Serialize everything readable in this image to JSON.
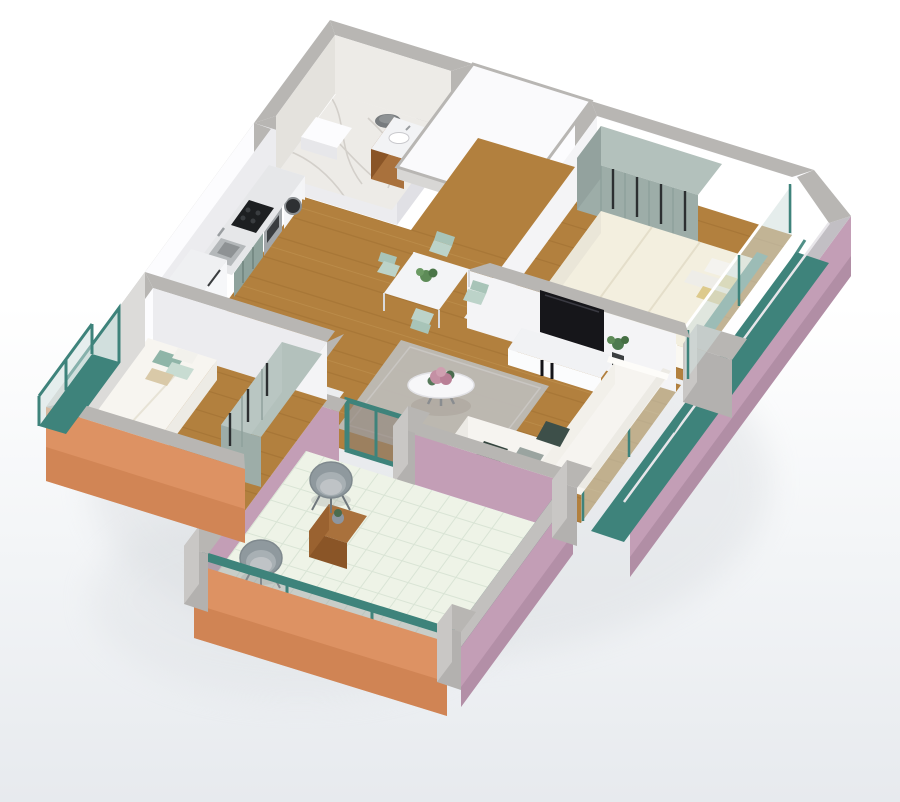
{
  "scene": {
    "title": "3D isometric apartment floor plan render",
    "type": "architectural-visualization",
    "no_visible_text": true
  },
  "palette": {
    "bg_top": "#ffffff",
    "bg_bottom": "#e7eaee",
    "cut": "#b8b6b3",
    "cut_light": "#c9c7c4",
    "wall_white": "#fcfcfe",
    "wall_light": "#f4f4f6",
    "wall_shade": "#ececef",
    "wall_shade2": "#e0e0e5",
    "marble": "#edebe7",
    "marble_vein": "#d0cdc7",
    "wood": "#b2803e",
    "wood_line": "#8f6128",
    "wood_hi": "#caa05f",
    "furniture_wood": "#a9713c",
    "furniture_wood_dark": "#8a5527",
    "pink": "#c39eb6",
    "pink_dark": "#a8859c",
    "orange": "#dd9263",
    "orange_dark": "#c57848",
    "teal": "#3e837b",
    "teal_dark": "#2f6e66",
    "glass": "#cfdfdd",
    "glass_gray": "#9aa0a2",
    "sage": "#b3c1bc",
    "sage_dark": "#9dada8",
    "cream": "#f3efdf",
    "rug": "#bdbab6",
    "rug_line": "#c9c6c2",
    "tile": "#eef3e7",
    "tile_line": "#d9e4d5",
    "sofa": "#f6f4f0",
    "tv_black": "#16161a",
    "steel": "#a3a7aa",
    "mint": "#bcd3c9",
    "mint_dark": "#a8c4b8",
    "chair_gray": "#8f999e",
    "shadow": "#d7dade"
  },
  "rooms": {
    "bathroom": {
      "label": "Bathroom with marble walls, vanity sink and toilet"
    },
    "entry_hall": {
      "label": "Entry hall with white ceiling slab"
    },
    "bedroom_primary": {
      "label": "Primary bedroom with double bed and sage wardrobe"
    },
    "living_room": {
      "label": "Living room with sectional sofa, rug, coffee table and TV"
    },
    "kitchen": {
      "label": "Kitchen with counter, cooktop, oven, sink, washer and fridge"
    },
    "dining": {
      "label": "Dining table with mint chairs"
    },
    "bedroom_second": {
      "label": "Second bedroom with bed, wardrobe and juliet balcony"
    },
    "terrace": {
      "label": "Tiled terrace with round chairs and wooden cube table"
    },
    "balcony_east": {
      "label": "East balcony with teal floor and pink parapet"
    }
  },
  "furniture": {
    "bathroom": [
      "vanity-sink",
      "toilet",
      "shower-tray",
      "glass-panel"
    ],
    "kitchen": [
      "counter",
      "cooktop",
      "oven",
      "sink",
      "washing-machine",
      "fridge"
    ],
    "dining": [
      "table",
      "plant-centerpiece",
      "chair",
      "chair",
      "chair",
      "chair"
    ],
    "living_room": [
      "tv-console",
      "tv",
      "plant",
      "rug",
      "round-coffee-table",
      "flower-bouquet",
      "sectional-sofa",
      "cushions"
    ],
    "bedroom_primary": [
      "wardrobe",
      "double-bed",
      "pillows",
      "teal-headboard"
    ],
    "bedroom_second": [
      "wardrobe",
      "bed",
      "pillows"
    ],
    "terrace": [
      "cube-table",
      "plant-pot",
      "bucket-chair",
      "bucket-chair"
    ]
  }
}
